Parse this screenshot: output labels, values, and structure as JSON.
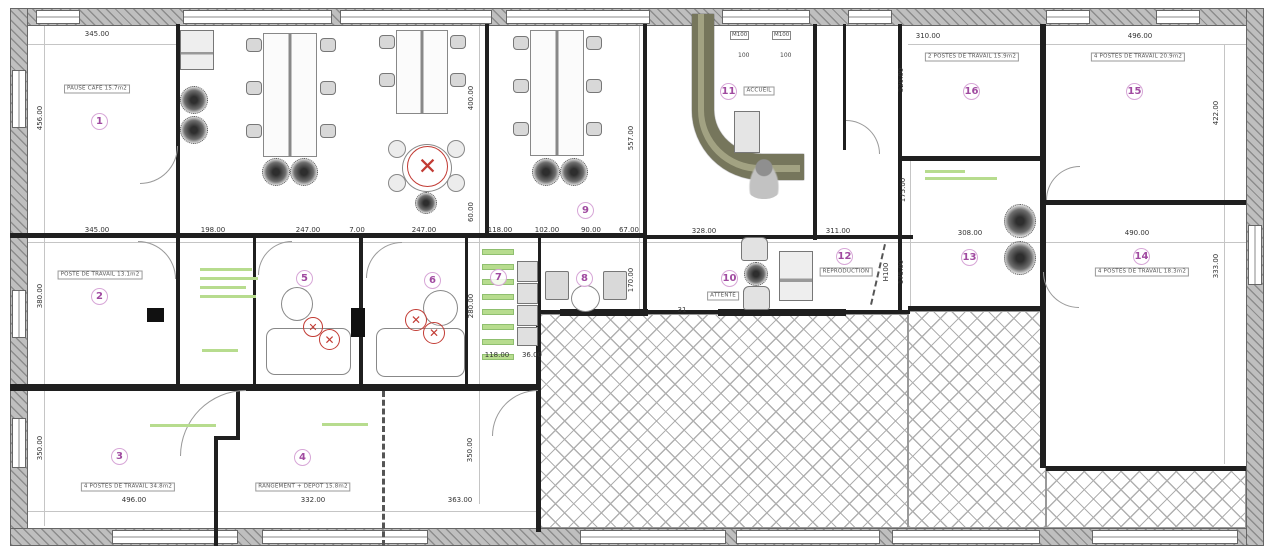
{
  "document": {
    "kind": "architectural floor plan",
    "language": "French"
  },
  "colors": {
    "wall": "#1f1f1f",
    "exterior_wall": "#bfbfbf",
    "badge_ring": "#d7a6d7",
    "badge_number": "#a04aa0",
    "annotation_green": "#b7dc8e",
    "demolition_red": "#c23b34",
    "entrance_wall_olive": "#76765c"
  },
  "rooms": [
    {
      "num": "1",
      "badge": [
        100,
        122
      ],
      "label": "PAUSE CAFE 15.7m2",
      "label_pos": [
        97,
        89
      ]
    },
    {
      "num": "2",
      "badge": [
        100,
        297
      ],
      "label": "POSTE DE TRAVAIL 13.1m2",
      "label_pos": [
        100,
        275
      ]
    },
    {
      "num": "3",
      "badge": [
        120,
        457
      ],
      "label": "4 POSTES DE TRAVAIL 34.8m2",
      "label_pos": [
        128,
        487
      ]
    },
    {
      "num": "4",
      "badge": [
        303,
        458
      ],
      "label": "RANGEMENT + DEPOT 15.8m2",
      "label_pos": [
        303,
        487
      ]
    },
    {
      "num": "5",
      "badge": [
        305,
        279
      ],
      "label": "",
      "label_pos": null
    },
    {
      "num": "6",
      "badge": [
        433,
        281
      ],
      "label": "",
      "label_pos": null
    },
    {
      "num": "7",
      "badge": [
        499,
        278
      ],
      "label": "",
      "label_pos": null
    },
    {
      "num": "8",
      "badge": [
        585,
        279
      ],
      "label": "",
      "label_pos": null
    },
    {
      "num": "9",
      "badge": [
        586,
        211
      ],
      "label": "",
      "label_pos": null
    },
    {
      "num": "10",
      "badge": [
        730,
        279
      ],
      "label": "ATTENTE",
      "label_pos": [
        723,
        296
      ]
    },
    {
      "num": "11",
      "badge": [
        729,
        92
      ],
      "label": "ACCUEIL",
      "label_pos": [
        759,
        91
      ]
    },
    {
      "num": "12",
      "badge": [
        845,
        257
      ],
      "label": "REPRODUCTION",
      "label_pos": [
        846,
        272
      ]
    },
    {
      "num": "13",
      "badge": [
        970,
        258
      ],
      "label": "",
      "label_pos": null
    },
    {
      "num": "14",
      "badge": [
        1142,
        257
      ],
      "label": "4 POSTES DE TRAVAIL 18.3m2",
      "label_pos": [
        1142,
        272
      ]
    },
    {
      "num": "15",
      "badge": [
        1135,
        92
      ],
      "label": "4 POSTES DE TRAVAIL 20.9m2",
      "label_pos": [
        1138,
        57
      ]
    },
    {
      "num": "16",
      "badge": [
        972,
        92
      ],
      "label": "2 POSTES DE TRAVAIL 15.9m2",
      "label_pos": [
        972,
        57
      ]
    }
  ],
  "dimensions": [
    {
      "t": "345.00",
      "x": 97,
      "y": 34
    },
    {
      "t": "310.00",
      "x": 928,
      "y": 36
    },
    {
      "t": "496.00",
      "x": 1140,
      "y": 36
    },
    {
      "t": "456.00",
      "x": 40,
      "y": 118,
      "v": 1
    },
    {
      "t": "380.00",
      "x": 40,
      "y": 296,
      "v": 1
    },
    {
      "t": "350.00",
      "x": 40,
      "y": 448,
      "v": 1
    },
    {
      "t": "345.00",
      "x": 97,
      "y": 230
    },
    {
      "t": "198.00",
      "x": 213,
      "y": 230
    },
    {
      "t": "247.00",
      "x": 308,
      "y": 230
    },
    {
      "t": "7.00",
      "x": 357,
      "y": 230
    },
    {
      "t": "247.00",
      "x": 424,
      "y": 230
    },
    {
      "t": "118.00",
      "x": 500,
      "y": 230
    },
    {
      "t": "102.00",
      "x": 547,
      "y": 230
    },
    {
      "t": "90.00",
      "x": 591,
      "y": 230
    },
    {
      "t": "67.00",
      "x": 629,
      "y": 230
    },
    {
      "t": "328.00",
      "x": 704,
      "y": 231
    },
    {
      "t": "311.00",
      "x": 838,
      "y": 231
    },
    {
      "t": "308.00",
      "x": 970,
      "y": 233
    },
    {
      "t": "490.00",
      "x": 1137,
      "y": 233
    },
    {
      "t": "118.00",
      "x": 497,
      "y": 355
    },
    {
      "t": "36.00",
      "x": 532,
      "y": 355
    },
    {
      "t": "31",
      "x": 682,
      "y": 310
    },
    {
      "t": "496.00",
      "x": 134,
      "y": 500
    },
    {
      "t": "332.00",
      "x": 313,
      "y": 500
    },
    {
      "t": "363.00",
      "x": 460,
      "y": 500
    },
    {
      "t": "400.00",
      "x": 471,
      "y": 98,
      "v": 1
    },
    {
      "t": "60.00",
      "x": 471,
      "y": 212,
      "v": 1
    },
    {
      "t": "557.00",
      "x": 631,
      "y": 138,
      "v": 1
    },
    {
      "t": "170.00",
      "x": 631,
      "y": 280,
      "v": 1
    },
    {
      "t": "280.00",
      "x": 471,
      "y": 306,
      "v": 1
    },
    {
      "t": "350.00",
      "x": 470,
      "y": 450,
      "v": 1
    },
    {
      "t": "320.00",
      "x": 901,
      "y": 80,
      "v": 1
    },
    {
      "t": "175.00",
      "x": 903,
      "y": 190,
      "v": 1
    },
    {
      "t": "175.00",
      "x": 901,
      "y": 272,
      "v": 1
    },
    {
      "t": "H100",
      "x": 886,
      "y": 272,
      "v": 1
    },
    {
      "t": "422.00",
      "x": 1216,
      "y": 113,
      "v": 1
    },
    {
      "t": "333.00",
      "x": 1216,
      "y": 266,
      "v": 1
    }
  ],
  "markers": {
    "boxed": [
      {
        "t": "M100",
        "x": 730,
        "y": 31
      },
      {
        "t": "M100",
        "x": 772,
        "y": 31
      }
    ],
    "plain": [
      {
        "t": "100",
        "x": 738,
        "y": 52
      },
      {
        "t": "100",
        "x": 780,
        "y": 52
      }
    ]
  },
  "annotations": {
    "green_rows": [
      [
        200,
        268,
        52
      ],
      [
        200,
        277,
        58
      ],
      [
        200,
        286,
        46
      ],
      [
        200,
        295,
        56
      ],
      [
        202,
        349,
        36
      ],
      [
        150,
        424,
        66
      ],
      [
        322,
        423,
        46
      ],
      [
        925,
        170,
        40
      ],
      [
        925,
        177,
        72
      ]
    ],
    "shelf_bars": [
      [
        482,
        249,
        32,
        6
      ],
      [
        482,
        264,
        32,
        6
      ],
      [
        482,
        279,
        32,
        6
      ],
      [
        482,
        294,
        32,
        6
      ],
      [
        482,
        309,
        32,
        6
      ],
      [
        482,
        324,
        32,
        6
      ],
      [
        482,
        339,
        32,
        6
      ],
      [
        482,
        354,
        32,
        6
      ]
    ]
  },
  "demolition_marks": [
    [
      303,
      317,
      20
    ],
    [
      319,
      329,
      21
    ],
    [
      405,
      309,
      22
    ],
    [
      423,
      322,
      22
    ],
    [
      407,
      146,
      41
    ]
  ],
  "geometry": {
    "exterior": [
      [
        10,
        8,
        1252,
        18
      ],
      [
        10,
        8,
        18,
        538
      ],
      [
        10,
        528,
        1252,
        18
      ],
      [
        1246,
        8,
        18,
        538
      ]
    ],
    "windows_h": [
      [
        36,
        10,
        44,
        14
      ],
      [
        183,
        10,
        149,
        14
      ],
      [
        340,
        10,
        152,
        14
      ],
      [
        506,
        10,
        144,
        14
      ],
      [
        722,
        10,
        88,
        14
      ],
      [
        848,
        10,
        44,
        14
      ],
      [
        1046,
        10,
        44,
        14
      ],
      [
        1156,
        10,
        44,
        14
      ],
      [
        112,
        530,
        126,
        14
      ],
      [
        262,
        530,
        166,
        14
      ],
      [
        580,
        530,
        146,
        14
      ],
      [
        736,
        530,
        144,
        14
      ],
      [
        892,
        530,
        148,
        14
      ],
      [
        1092,
        530,
        146,
        14
      ]
    ],
    "windows_v": [
      [
        12,
        70,
        14,
        58
      ],
      [
        12,
        290,
        14,
        48
      ],
      [
        12,
        418,
        14,
        50
      ],
      [
        1248,
        225,
        14,
        60
      ]
    ],
    "walls": [
      [
        10,
        233,
        480,
        5
      ],
      [
        485,
        233,
        162,
        5
      ],
      [
        645,
        235,
        268,
        4
      ],
      [
        10,
        384,
        530,
        7
      ],
      [
        538,
        310,
        372,
        4
      ],
      [
        560,
        309,
        88,
        7
      ],
      [
        718,
        309,
        128,
        7
      ],
      [
        908,
        306,
        138,
        5
      ],
      [
        900,
        156,
        142,
        5
      ],
      [
        1046,
        200,
        200,
        5
      ],
      [
        1046,
        466,
        200,
        5
      ],
      [
        176,
        24,
        4,
        214
      ],
      [
        176,
        238,
        4,
        148
      ],
      [
        236,
        391,
        4,
        49
      ],
      [
        214,
        436,
        26,
        4
      ],
      [
        214,
        436,
        4,
        110
      ],
      [
        253,
        236,
        3,
        150
      ],
      [
        359,
        236,
        4,
        150
      ],
      [
        465,
        236,
        3,
        150
      ],
      [
        485,
        24,
        4,
        214
      ],
      [
        643,
        24,
        4,
        214
      ],
      [
        643,
        238,
        4,
        76
      ],
      [
        538,
        236,
        3,
        76
      ],
      [
        813,
        24,
        4,
        216
      ],
      [
        843,
        24,
        3,
        126
      ],
      [
        898,
        24,
        4,
        216
      ],
      [
        898,
        238,
        4,
        72
      ],
      [
        1040,
        24,
        6,
        444
      ],
      [
        536,
        310,
        5,
        222
      ]
    ],
    "dashed_walls": [
      {
        "r": [
          382,
          391,
          3,
          155
        ],
        "rot": 0
      },
      {
        "r": [
          884,
          244,
          2,
          62
        ],
        "rot": 13
      }
    ],
    "arcs": [
      [
        140,
        146,
        38,
        "br"
      ],
      [
        138,
        241,
        38,
        "tr"
      ],
      [
        258,
        241,
        34,
        "tl"
      ],
      [
        366,
        242,
        36,
        "tl"
      ],
      [
        180,
        390,
        66,
        "tl"
      ],
      [
        1043,
        272,
        36,
        "bl"
      ],
      [
        1046,
        166,
        34,
        "tl"
      ],
      [
        846,
        120,
        34,
        "tr"
      ],
      [
        492,
        390,
        46,
        "tl"
      ]
    ],
    "hatch_areas": [
      [
        540,
        314,
        368,
        214
      ],
      [
        908,
        311,
        138,
        217
      ],
      [
        1046,
        470,
        200,
        58
      ]
    ],
    "dim_lines": [
      [
        28,
        44,
        150,
        1
      ],
      [
        908,
        44,
        132,
        1
      ],
      [
        1046,
        44,
        200,
        1
      ],
      [
        28,
        242,
        1218,
        1
      ],
      [
        28,
        511,
        510,
        1
      ],
      [
        44,
        26,
        1,
        500
      ],
      [
        1224,
        44,
        1,
        420
      ],
      [
        479,
        26,
        1,
        478
      ],
      [
        639,
        26,
        1,
        286
      ],
      [
        910,
        160,
        1,
        146
      ]
    ],
    "entrance_olive": [
      692,
      14,
      112,
      166
    ]
  },
  "furniture": [
    {
      "t": "desk2",
      "r": [
        263,
        33,
        54,
        124
      ]
    },
    {
      "t": "desk2",
      "r": [
        396,
        30,
        52,
        84
      ]
    },
    {
      "t": "desk2",
      "r": [
        530,
        30,
        54,
        126
      ]
    },
    {
      "t": "chair",
      "r": [
        246,
        38,
        16,
        14
      ]
    },
    {
      "t": "chair",
      "r": [
        246,
        81,
        16,
        14
      ]
    },
    {
      "t": "chair",
      "r": [
        246,
        124,
        16,
        14
      ]
    },
    {
      "t": "chair",
      "r": [
        320,
        38,
        16,
        14
      ]
    },
    {
      "t": "chair",
      "r": [
        320,
        81,
        16,
        14
      ]
    },
    {
      "t": "chair",
      "r": [
        320,
        124,
        16,
        14
      ]
    },
    {
      "t": "chair",
      "r": [
        379,
        35,
        16,
        14
      ]
    },
    {
      "t": "chair",
      "r": [
        379,
        73,
        16,
        14
      ]
    },
    {
      "t": "chair",
      "r": [
        450,
        35,
        16,
        14
      ]
    },
    {
      "t": "chair",
      "r": [
        450,
        73,
        16,
        14
      ]
    },
    {
      "t": "chair",
      "r": [
        513,
        36,
        16,
        14
      ]
    },
    {
      "t": "chair",
      "r": [
        513,
        79,
        16,
        14
      ]
    },
    {
      "t": "chair",
      "r": [
        513,
        122,
        16,
        14
      ]
    },
    {
      "t": "chair",
      "r": [
        586,
        36,
        16,
        14
      ]
    },
    {
      "t": "chair",
      "r": [
        586,
        79,
        16,
        14
      ]
    },
    {
      "t": "chair",
      "r": [
        586,
        122,
        16,
        14
      ]
    },
    {
      "t": "roundtable",
      "r": [
        402,
        144,
        50,
        48
      ]
    },
    {
      "t": "tub",
      "r": [
        388,
        140,
        18,
        18
      ]
    },
    {
      "t": "tub",
      "r": [
        447,
        140,
        18,
        18
      ]
    },
    {
      "t": "tub",
      "r": [
        388,
        174,
        18,
        18
      ]
    },
    {
      "t": "tub",
      "r": [
        447,
        174,
        18,
        18
      ]
    },
    {
      "t": "plant",
      "r": [
        180,
        86,
        26,
        26
      ]
    },
    {
      "t": "plant",
      "r": [
        180,
        116,
        26,
        26
      ]
    },
    {
      "t": "plant",
      "r": [
        262,
        158,
        26,
        26
      ]
    },
    {
      "t": "plant",
      "r": [
        290,
        158,
        26,
        26
      ]
    },
    {
      "t": "plant",
      "r": [
        532,
        158,
        26,
        26
      ]
    },
    {
      "t": "plant",
      "r": [
        560,
        158,
        26,
        26
      ]
    },
    {
      "t": "plant",
      "r": [
        415,
        192,
        20,
        20
      ]
    },
    {
      "t": "plant",
      "r": [
        744,
        262,
        22,
        22
      ]
    },
    {
      "t": "plant",
      "r": [
        1004,
        204,
        30,
        32
      ]
    },
    {
      "t": "plant",
      "r": [
        1004,
        241,
        30,
        32
      ]
    },
    {
      "t": "printer",
      "r": [
        180,
        30,
        34,
        40
      ]
    },
    {
      "t": "printer",
      "r": [
        779,
        251,
        34,
        50
      ]
    },
    {
      "t": "pedestal",
      "r": [
        734,
        111,
        26,
        42
      ]
    },
    {
      "t": "person",
      "r": [
        743,
        153,
        42,
        46
      ]
    },
    {
      "t": "armchair",
      "r": [
        741,
        237,
        27,
        24
      ]
    },
    {
      "t": "armchair",
      "r": [
        743,
        286,
        27,
        24
      ]
    },
    {
      "t": "sidetable",
      "r": [
        545,
        271,
        24,
        29
      ]
    },
    {
      "t": "sidetable",
      "r": [
        603,
        271,
        24,
        29
      ]
    },
    {
      "t": "smalltable",
      "r": [
        571,
        285,
        29,
        27
      ]
    },
    {
      "t": "kitchen",
      "r": [
        517,
        261,
        21,
        21
      ]
    },
    {
      "t": "kitchen",
      "r": [
        517,
        283,
        21,
        21
      ]
    },
    {
      "t": "kitchen",
      "r": [
        517,
        305,
        21,
        21
      ]
    },
    {
      "t": "kitchen",
      "r": [
        517,
        327,
        21,
        19
      ]
    },
    {
      "t": "toilet",
      "r": [
        281,
        287,
        32,
        34
      ]
    },
    {
      "t": "toilet",
      "r": [
        423,
        290,
        35,
        36
      ]
    },
    {
      "t": "couch",
      "r": [
        266,
        328,
        85,
        47
      ]
    },
    {
      "t": "couch",
      "r": [
        376,
        328,
        89,
        49
      ]
    },
    {
      "t": "column",
      "r": [
        147,
        308,
        17,
        14
      ]
    },
    {
      "t": "column",
      "r": [
        351,
        308,
        14,
        29
      ]
    }
  ]
}
